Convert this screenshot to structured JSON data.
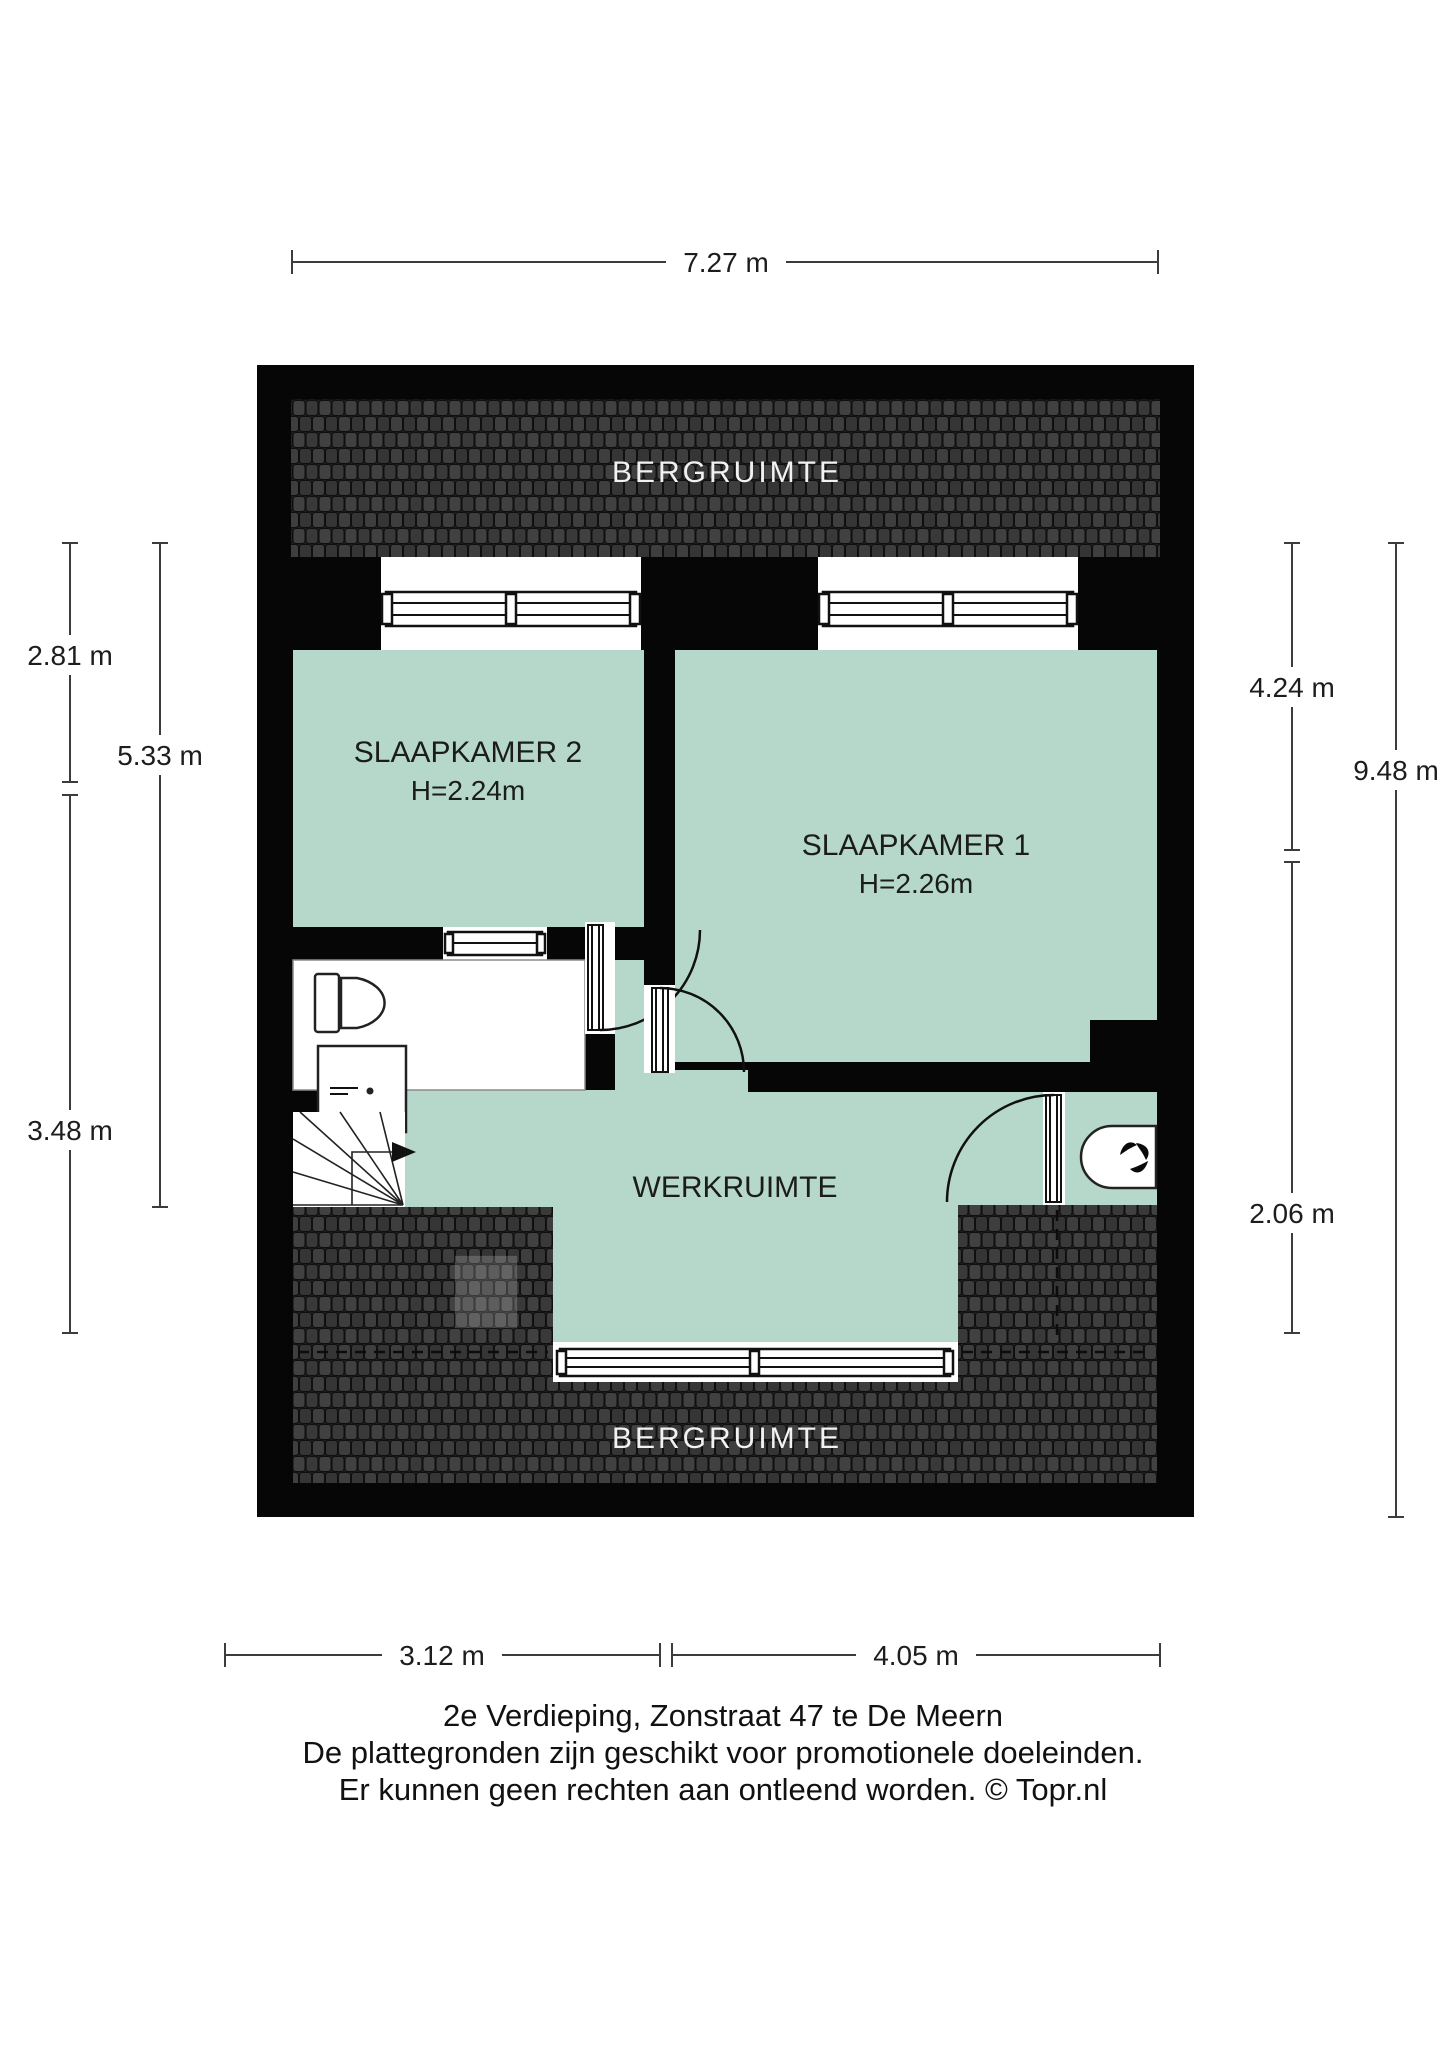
{
  "colors": {
    "room_fill": "#b6d8cb",
    "wall": "#060606",
    "dim": "#3c3c3c",
    "text": "#1c1c1c",
    "roof_label": "#f2f2f2"
  },
  "rooms": {
    "bergruimte_top": {
      "label": "BERGRUIMTE"
    },
    "bergruimte_bottom": {
      "label": "BERGRUIMTE"
    },
    "slaapkamer2": {
      "label": "SLAAPKAMER 2",
      "ceiling_height": "H=2.24m"
    },
    "slaapkamer1": {
      "label": "SLAAPKAMER 1",
      "ceiling_height": "H=2.26m"
    },
    "werkruimte": {
      "label": "WERKRUIMTE"
    }
  },
  "dimensions": {
    "top_width": {
      "label": "7.27 m"
    },
    "left_upper": {
      "label": "2.81 m"
    },
    "left_full": {
      "label": "5.33 m"
    },
    "left_lower": {
      "label": "3.48 m"
    },
    "right_upper": {
      "label": "4.24 m"
    },
    "right_full": {
      "label": "9.48 m"
    },
    "right_lower": {
      "label": "2.06 m"
    },
    "bottom_left": {
      "label": "3.12 m"
    },
    "bottom_right": {
      "label": "4.05 m"
    }
  },
  "footer": {
    "line1": "2e Verdieping, Zonstraat 47 te De Meern",
    "line2": "De plattegronden zijn geschikt voor promotionele doeleinden.",
    "line3": "Er kunnen geen rechten aan ontleend worden. © Topr.nl"
  }
}
